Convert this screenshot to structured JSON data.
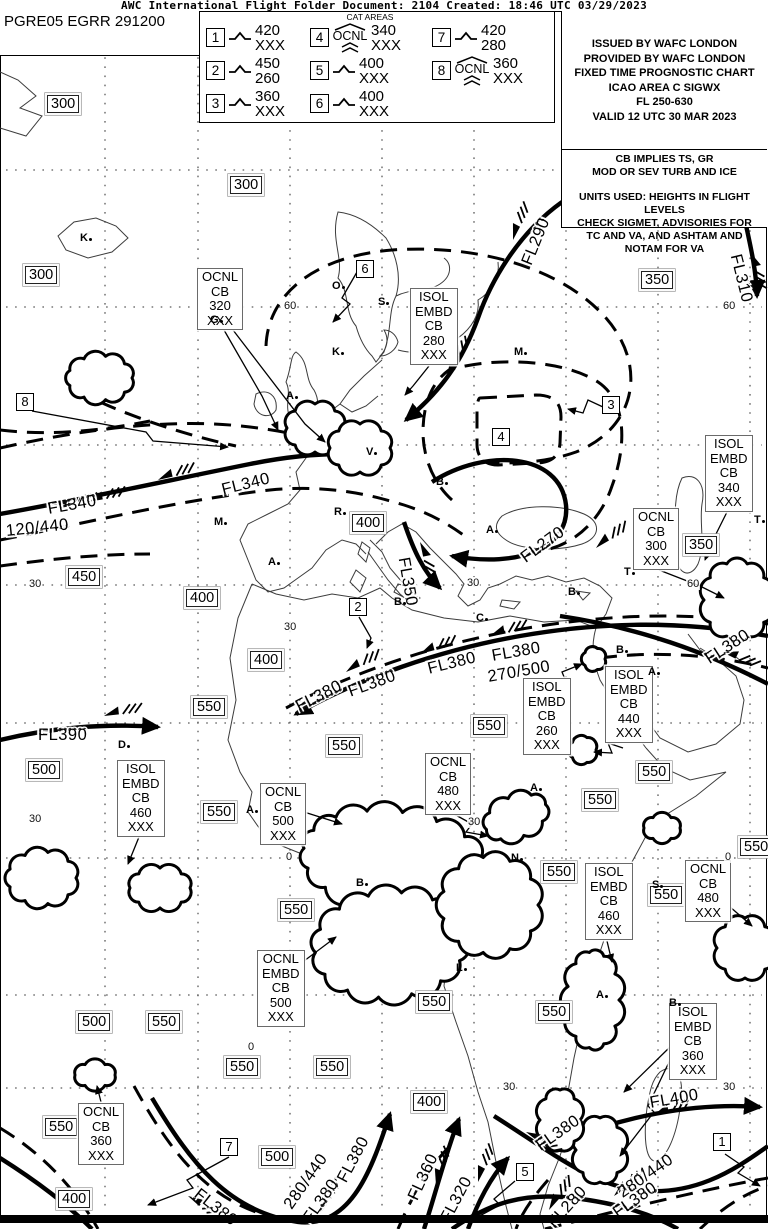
{
  "header": {
    "title": "AWC International Flight Folder Document: 2104 Created: 18:46 UTC 03/29/2023"
  },
  "doc_id": "PGRE05 EGRR 291200",
  "colors": {
    "ink": "#000000",
    "paper": "#ffffff"
  },
  "legend": {
    "title": "CAT AREAS",
    "items": [
      {
        "num": "1",
        "cls": "turb",
        "qualifier": "",
        "top": "420",
        "bottom": "XXX"
      },
      {
        "num": "2",
        "cls": "turb",
        "qualifier": "",
        "top": "450",
        "bottom": "260"
      },
      {
        "num": "3",
        "cls": "turb",
        "qualifier": "",
        "top": "360",
        "bottom": "XXX"
      },
      {
        "num": "4",
        "cls": "ocnl",
        "qualifier": "OCNL",
        "top": "340",
        "bottom": "XXX"
      },
      {
        "num": "5",
        "cls": "turb",
        "qualifier": "",
        "top": "400",
        "bottom": "XXX"
      },
      {
        "num": "6",
        "cls": "turb",
        "qualifier": "",
        "top": "400",
        "bottom": "XXX"
      },
      {
        "num": "7",
        "cls": "turb",
        "qualifier": "",
        "top": "420",
        "bottom": "280"
      },
      {
        "num": "8",
        "cls": "ocnl",
        "qualifier": "OCNL",
        "top": "360",
        "bottom": "XXX"
      }
    ]
  },
  "info_box": {
    "issue_lines": "ISSUED BY WAFC LONDON\nPROVIDED BY WAFC LONDON\nFIXED TIME PROGNOSTIC CHART\nICAO AREA C SIGWX\nFL 250-630\nVALID 12 UTC 30 MAR 2023",
    "cb_note": "CB IMPLIES TS, GR\nMOD OR SEV TURB AND ICE",
    "units_note": "UNITS USED: HEIGHTS IN FLIGHT LEVELS\nCHECK SIGMET, ADVISORIES FOR\nTC AND VA, AND ASHTAM AND\nNOTAM FOR VA"
  },
  "map": {
    "trop_boxes": [
      {
        "t": "300",
        "x": 47,
        "y": 95
      },
      {
        "t": "300",
        "x": 230,
        "y": 176
      },
      {
        "t": "300",
        "x": 25,
        "y": 266
      },
      {
        "t": "350",
        "x": 641,
        "y": 271
      },
      {
        "t": "400",
        "x": 352,
        "y": 514
      },
      {
        "t": "350",
        "x": 685,
        "y": 536
      },
      {
        "t": "450",
        "x": 68,
        "y": 568
      },
      {
        "t": "400",
        "x": 186,
        "y": 589
      },
      {
        "t": "400",
        "x": 250,
        "y": 651
      },
      {
        "t": "550",
        "x": 193,
        "y": 698
      },
      {
        "t": "550",
        "x": 473,
        "y": 717
      },
      {
        "t": "550",
        "x": 328,
        "y": 737
      },
      {
        "t": "500",
        "x": 28,
        "y": 761
      },
      {
        "t": "550",
        "x": 638,
        "y": 763
      },
      {
        "t": "550",
        "x": 584,
        "y": 791
      },
      {
        "t": "550",
        "x": 203,
        "y": 803
      },
      {
        "t": "550",
        "x": 740,
        "y": 838
      },
      {
        "t": "550",
        "x": 543,
        "y": 863
      },
      {
        "t": "550",
        "x": 650,
        "y": 886
      },
      {
        "t": "550",
        "x": 280,
        "y": 901
      },
      {
        "t": "550",
        "x": 418,
        "y": 993
      },
      {
        "t": "550",
        "x": 538,
        "y": 1003
      },
      {
        "t": "500",
        "x": 78,
        "y": 1013
      },
      {
        "t": "550",
        "x": 148,
        "y": 1013
      },
      {
        "t": "550",
        "x": 226,
        "y": 1058
      },
      {
        "t": "550",
        "x": 316,
        "y": 1058
      },
      {
        "t": "400",
        "x": 413,
        "y": 1093
      },
      {
        "t": "550",
        "x": 45,
        "y": 1118
      },
      {
        "t": "500",
        "x": 261,
        "y": 1148
      },
      {
        "t": "400",
        "x": 58,
        "y": 1190
      }
    ],
    "cat_markers": [
      {
        "t": "6",
        "x": 356,
        "y": 260
      },
      {
        "t": "8",
        "x": 16,
        "y": 393
      },
      {
        "t": "3",
        "x": 602,
        "y": 396
      },
      {
        "t": "4",
        "x": 492,
        "y": 428
      },
      {
        "t": "2",
        "x": 349,
        "y": 598
      },
      {
        "t": "7",
        "x": 220,
        "y": 1138
      },
      {
        "t": "5",
        "x": 516,
        "y": 1163
      },
      {
        "t": "1",
        "x": 713,
        "y": 1133
      }
    ],
    "cb_boxes": [
      {
        "t": "OCNL\nCB\n320\nXXX",
        "x": 197,
        "y": 268
      },
      {
        "t": "ISOL\nEMBD\nCB\n280\nXXX",
        "x": 410,
        "y": 288
      },
      {
        "t": "ISOL\nEMBD\nCB\n340\nXXX",
        "x": 705,
        "y": 435
      },
      {
        "t": "OCNL\nCB\n300\nXXX",
        "x": 633,
        "y": 508
      },
      {
        "t": "ISOL\nEMBD\nCB\n260\nXXX",
        "x": 523,
        "y": 678
      },
      {
        "t": "ISOL\nEMBD\nCB\n440\nXXX",
        "x": 605,
        "y": 666
      },
      {
        "t": "ISOL\nEMBD\nCB\n460\nXXX",
        "x": 117,
        "y": 760
      },
      {
        "t": "OCNL\nCB\n500\nXXX",
        "x": 260,
        "y": 783
      },
      {
        "t": "OCNL\nCB\n480\nXXX",
        "x": 425,
        "y": 753
      },
      {
        "t": "ISOL\nEMBD\nCB\n460\nXXX",
        "x": 585,
        "y": 863
      },
      {
        "t": "OCNL\nCB\n480\nXXX",
        "x": 685,
        "y": 860
      },
      {
        "t": "OCNL\nEMBD\nCB\n500\nXXX",
        "x": 257,
        "y": 950
      },
      {
        "t": "ISOL\nEMBD\nCB\n360\nXXX",
        "x": 669,
        "y": 1003
      },
      {
        "t": "OCNL\nCB\n360\nXXX",
        "x": 78,
        "y": 1103
      }
    ],
    "jet_labels": [
      {
        "t": "FL290",
        "x": 527,
        "y": 255,
        "r": -68
      },
      {
        "t": "FL310",
        "x": 735,
        "y": 245,
        "r": 76
      },
      {
        "t": "FL340",
        "x": 48,
        "y": 500,
        "r": -10
      },
      {
        "t": "FL340",
        "x": 222,
        "y": 481,
        "r": -14
      },
      {
        "t": "120/440",
        "x": 6,
        "y": 522,
        "r": -6
      },
      {
        "t": "FL350",
        "x": 403,
        "y": 548,
        "r": 80
      },
      {
        "t": "FL270",
        "x": 523,
        "y": 550,
        "r": -36
      },
      {
        "t": "FL380",
        "x": 297,
        "y": 698,
        "r": -27
      },
      {
        "t": "FL380",
        "x": 349,
        "y": 683,
        "r": -20
      },
      {
        "t": "FL380",
        "x": 428,
        "y": 660,
        "r": -14
      },
      {
        "t": "FL380",
        "x": 492,
        "y": 647,
        "r": -10
      },
      {
        "t": "270/500",
        "x": 488,
        "y": 668,
        "r": -10
      },
      {
        "t": "FL380",
        "x": 707,
        "y": 651,
        "r": -33
      },
      {
        "t": "FL390",
        "x": 38,
        "y": 726,
        "r": 0
      },
      {
        "t": "FL400",
        "x": 650,
        "y": 1094,
        "r": -10
      },
      {
        "t": "FL380",
        "x": 196,
        "y": 1183,
        "r": 38
      },
      {
        "t": "280/440",
        "x": 288,
        "y": 1198,
        "r": -55
      },
      {
        "t": "FL380",
        "x": 307,
        "y": 1212,
        "r": -55
      },
      {
        "t": "FL380",
        "x": 342,
        "y": 1172,
        "r": -62
      },
      {
        "t": "FL360",
        "x": 413,
        "y": 1190,
        "r": -65
      },
      {
        "t": "FL320",
        "x": 445,
        "y": 1212,
        "r": -62
      },
      {
        "t": "FL280",
        "x": 551,
        "y": 1216,
        "r": -48
      },
      {
        "t": "FL380",
        "x": 538,
        "y": 1138,
        "r": -35
      },
      {
        "t": "280/440",
        "x": 620,
        "y": 1185,
        "r": -35
      },
      {
        "t": "FL380",
        "x": 615,
        "y": 1205,
        "r": -35
      }
    ],
    "geo_labels": [
      {
        "t": "60",
        "x": 283,
        "y": 300
      },
      {
        "t": "60",
        "x": 722,
        "y": 300
      },
      {
        "t": "30",
        "x": 28,
        "y": 578
      },
      {
        "t": "30",
        "x": 466,
        "y": 577
      },
      {
        "t": "60",
        "x": 686,
        "y": 578
      },
      {
        "t": "30",
        "x": 283,
        "y": 621
      },
      {
        "t": "30",
        "x": 28,
        "y": 813
      },
      {
        "t": "30",
        "x": 467,
        "y": 816
      },
      {
        "t": "0",
        "x": 285,
        "y": 851
      },
      {
        "t": "0",
        "x": 724,
        "y": 851
      },
      {
        "t": "0",
        "x": 247,
        "y": 1041
      },
      {
        "t": "30",
        "x": 502,
        "y": 1081
      },
      {
        "t": "30",
        "x": 722,
        "y": 1081
      }
    ],
    "city_markers": [
      {
        "t": "K",
        "x": 80,
        "y": 232
      },
      {
        "t": "G",
        "x": 210,
        "y": 314
      },
      {
        "t": "O",
        "x": 332,
        "y": 280
      },
      {
        "t": "S",
        "x": 378,
        "y": 296
      },
      {
        "t": "K",
        "x": 332,
        "y": 346
      },
      {
        "t": "M",
        "x": 514,
        "y": 346
      },
      {
        "t": "A",
        "x": 286,
        "y": 390
      },
      {
        "t": "V",
        "x": 366,
        "y": 446
      },
      {
        "t": "B",
        "x": 436,
        "y": 476
      },
      {
        "t": "R",
        "x": 334,
        "y": 506
      },
      {
        "t": "M",
        "x": 214,
        "y": 516
      },
      {
        "t": "A",
        "x": 268,
        "y": 556
      },
      {
        "t": "A",
        "x": 486,
        "y": 524
      },
      {
        "t": "B",
        "x": 394,
        "y": 596
      },
      {
        "t": "B",
        "x": 568,
        "y": 586
      },
      {
        "t": "T",
        "x": 624,
        "y": 566
      },
      {
        "t": "T",
        "x": 754,
        "y": 514
      },
      {
        "t": "C",
        "x": 476,
        "y": 612
      },
      {
        "t": "B",
        "x": 616,
        "y": 644
      },
      {
        "t": "A",
        "x": 648,
        "y": 666
      },
      {
        "t": "D",
        "x": 118,
        "y": 739
      },
      {
        "t": "A",
        "x": 246,
        "y": 804
      },
      {
        "t": "A",
        "x": 530,
        "y": 782
      },
      {
        "t": "N",
        "x": 511,
        "y": 852
      },
      {
        "t": "B",
        "x": 356,
        "y": 877
      },
      {
        "t": "S",
        "x": 652,
        "y": 879
      },
      {
        "t": "L",
        "x": 456,
        "y": 962
      },
      {
        "t": "A",
        "x": 596,
        "y": 989
      },
      {
        "t": "B",
        "x": 669,
        "y": 997
      }
    ]
  }
}
